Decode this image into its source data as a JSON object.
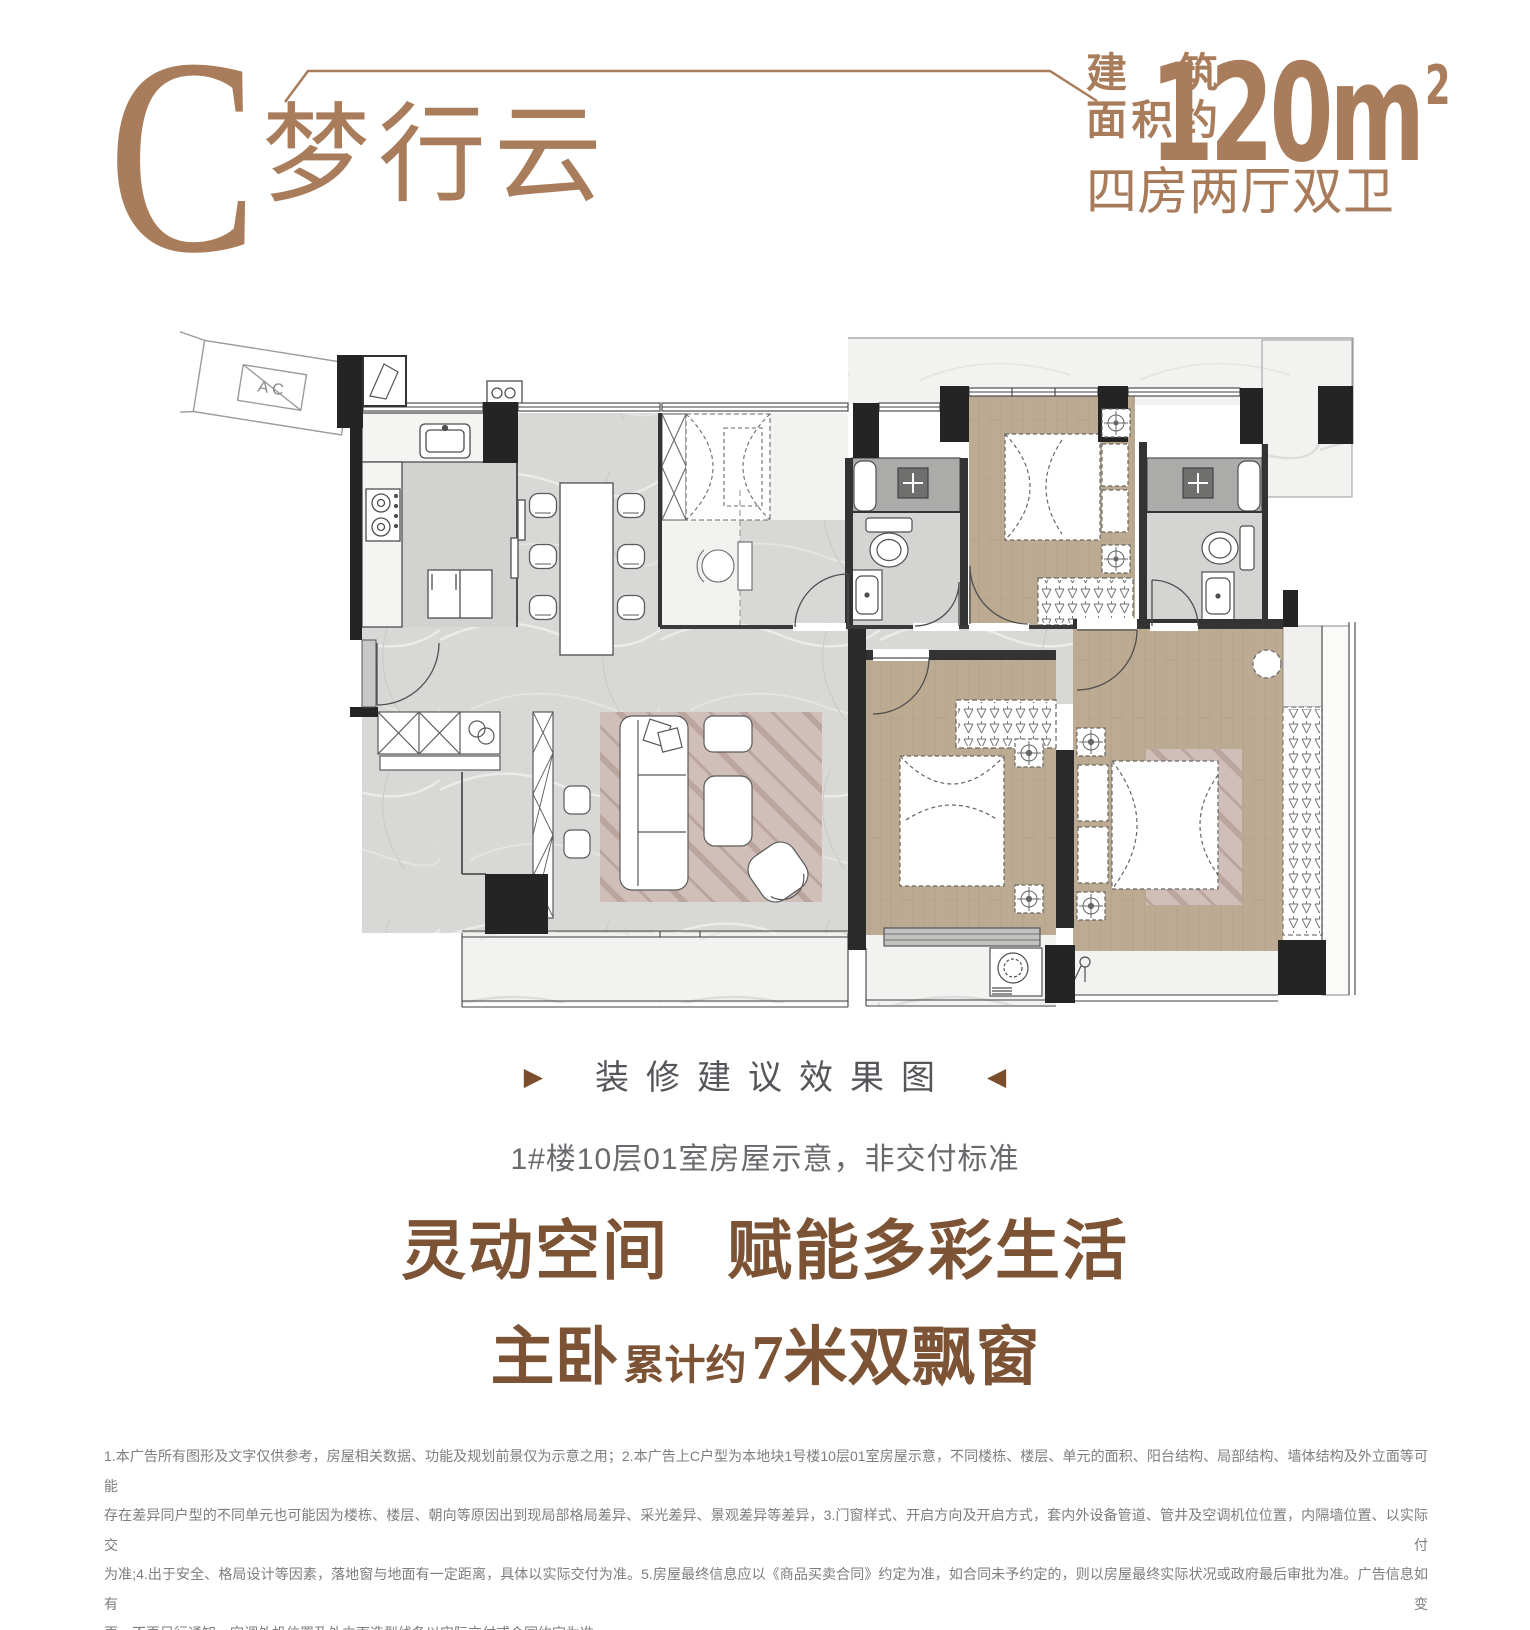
{
  "header": {
    "type_letter": "C",
    "type_name": "梦行云",
    "area_label_top": "建筑",
    "area_label_bottom": "面积约",
    "area_value": "120m",
    "area_superscript": "2",
    "layout_text": "四房两厅双卫"
  },
  "floor_plan": {
    "ac_platform_label": "A C"
  },
  "captions": {
    "left_arrow": "▶",
    "render_note": "装修建议效果图",
    "right_arrow": "◀",
    "unit_note": "1#楼10层01室房屋示意，非交付标准"
  },
  "slogans": {
    "line1_left": "灵动空间",
    "line1_right": "赋能多彩生活",
    "line2_big_prefix": "主卧",
    "line2_small": "累计约",
    "line2_big_suffix": "7米双飘窗"
  },
  "disclaimer": {
    "lines": [
      "1.本广告所有图形及文字仅供参考，房屋相关数据、功能及规划前景仅为示意之用；2.本广告上C户型为本地块1号楼10层01室房屋示意，不同楼栋、楼层、单元的面积、阳台结构、局部结构、墙体结构及外立面等可能",
      "存在差异同户型的不同单元也可能因为楼栋、楼层、朝向等原因出到现局部格局差异、采光差异、景观差异等差异，3.门窗样式、开启方向及开启方式，套内外设备管道、管井及空调机位位置，内隔墙位置、以实际交付",
      "为准;4.出于安全、格局设计等因素，落地窗与地面有一定距离，具体以实际交付为准。5.房屋最终信息应以《商品买卖合同》约定为准，如合同未予约定的，则以房屋最终实际状况或政府最后审批为准。广告信息如有变",
      "更，不再另行通知。空调外机位置及外立面造型线条以实际交付或合同约定为准。"
    ]
  },
  "colors": {
    "accent_light": "#A97D5B",
    "accent_dark": "#7C5435",
    "triangle": "#7A4E2D",
    "caption_text": "#55565A",
    "subcaption_text": "#696A6D",
    "disclaimer_text": "#7D7D7D",
    "wall": "#242424",
    "wood_floor": "#BCAA92",
    "marble_floor": "#D8D8D6"
  }
}
